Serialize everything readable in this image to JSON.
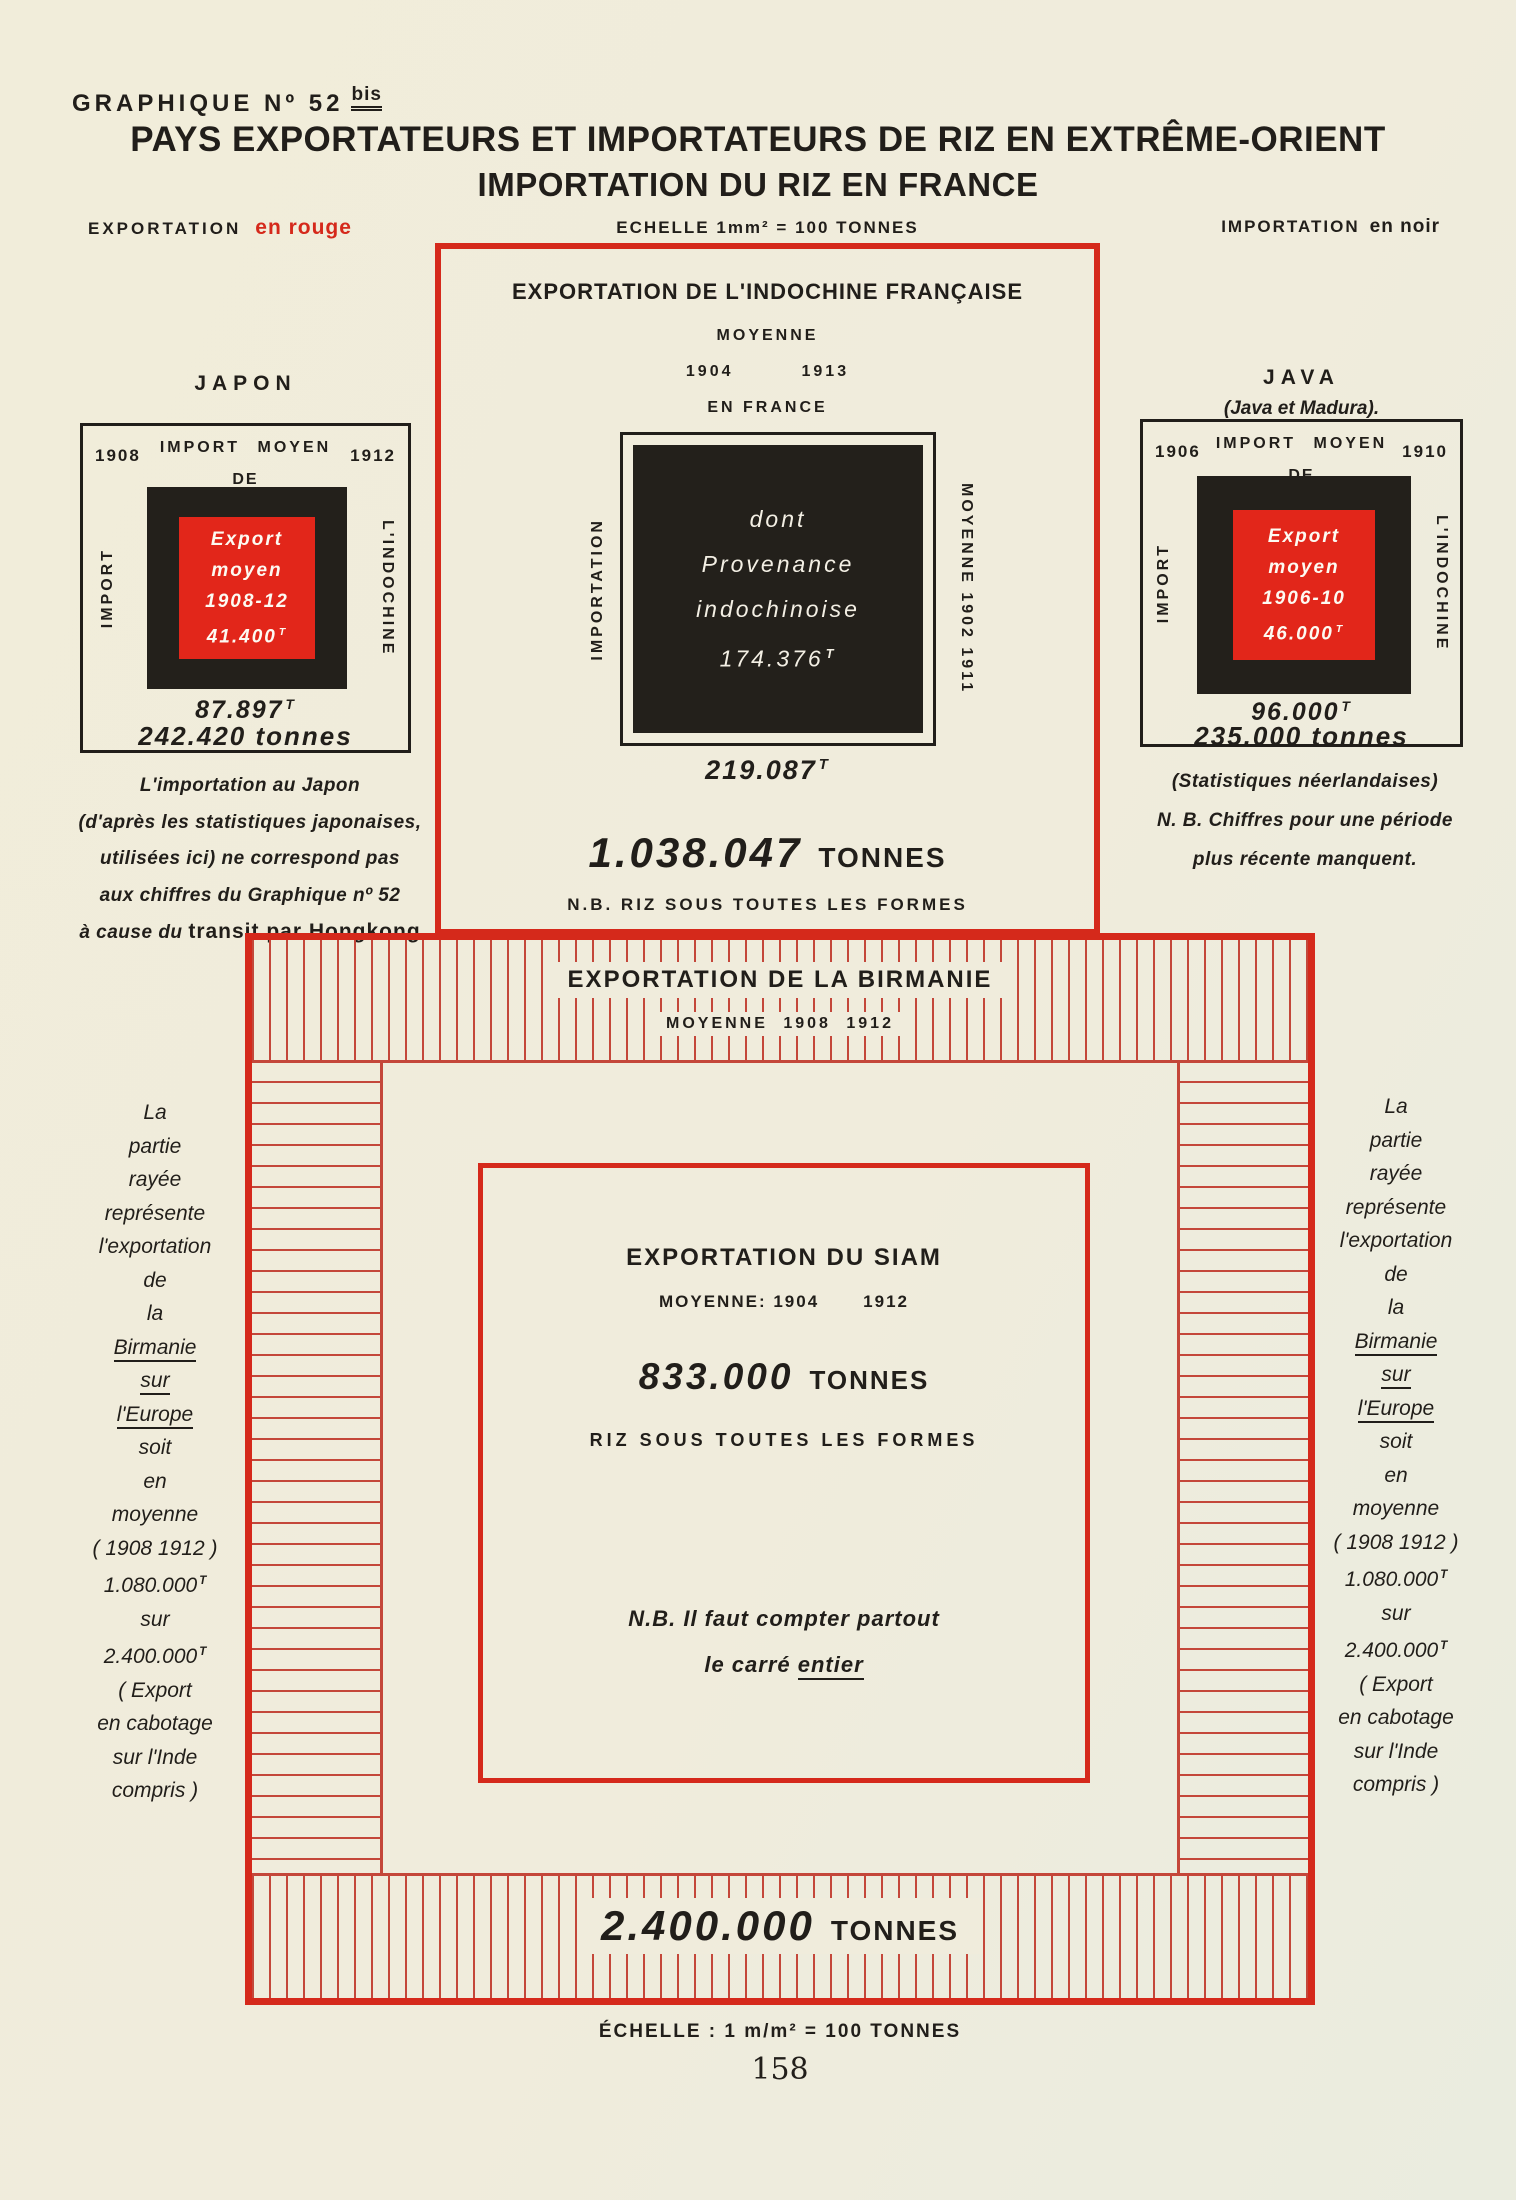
{
  "sup_t": "T",
  "colors": {
    "red": "#d5291b",
    "red_fill": "#e2261a",
    "hatch_red": "#c4473a",
    "ink": "#211e1a",
    "paper": "#f0ecdc"
  },
  "header": {
    "graph_label": "GRAPHIQUE Nº 52",
    "graph_label_sup": "bis",
    "title_line1": "PAYS EXPORTATEURS ET IMPORTATEURS DE RIZ EN EXTRÊME-ORIENT",
    "title_line2": "IMPORTATION DU RIZ EN FRANCE",
    "legend_export_label": "EXPORTATION",
    "legend_export_value": "en rouge",
    "scale_top": "ECHELLE 1mm² = 100 TONNES",
    "legend_import_label": "IMPORTATION",
    "legend_import_value": "en noir"
  },
  "japan": {
    "label": "JAPON",
    "year_start": "1908",
    "year_end": "1912",
    "band_top_line1": "IMPORT MOYEN",
    "band_top_line2": "DE",
    "band_left": "IMPORT",
    "band_right": "L'INDOCHINE",
    "center_lines": [
      "Export",
      "moyen",
      "1908-12",
      "41.400"
    ],
    "import_value": "87.897",
    "total_value": "242.420 tonnes",
    "note_lines": [
      "L'importation au Japon",
      "(d'après les statistiques japonaises,",
      "utilisées ici) ne correspond pas",
      "aux chiffres du Graphique nº 52",
      "à cause du "
    ],
    "note_bold": "transit par Hongkong"
  },
  "indochina": {
    "title": "EXPORTATION DE L'INDOCHINE FRANÇAISE",
    "moyenne": "MOYENNE",
    "year_start": "1904",
    "year_end": "1913",
    "en_france": "EN FRANCE",
    "band_left": "IMPORTATION",
    "band_right": "MOYENNE 1902 1911",
    "center_lines": [
      "dont",
      "Provenance",
      "indochinoise",
      "174.376"
    ],
    "france_value": "219.087",
    "total_number": "1.038.047",
    "total_unit": "TONNES",
    "note": "N.B. RIZ SOUS TOUTES LES FORMES"
  },
  "java": {
    "label": "JAVA",
    "sublabel": "(Java et Madura).",
    "year_start": "1906",
    "year_end": "1910",
    "band_top_line1": "IMPORT MOYEN",
    "band_top_line2": "DE",
    "band_left": "IMPORT",
    "band_right": "L'INDOCHINE",
    "center_lines": [
      "Export",
      "moyen",
      "1906-10",
      "46.000"
    ],
    "import_value": "96.000",
    "total_value": "235.000 tonnes",
    "note_lines": [
      "(Statistiques néerlandaises)",
      "N. B. Chiffres pour une période",
      "plus récente manquent."
    ]
  },
  "burma": {
    "title": "EXPORTATION DE LA BIRMANIE",
    "subtitle": "MOYENNE 1908 1912",
    "total_number": "2.400.000",
    "total_unit": "TONNES"
  },
  "siam": {
    "title": "EXPORTATION DU SIAM",
    "moyenne": "MOYENNE: 1904",
    "year2": "1912",
    "total_number": "833.000",
    "total_unit": "TONNES",
    "riz": "RIZ SOUS TOUTES LES FORMES",
    "nb1": "N.B. Il faut compter partout",
    "nb2_pre": "le carré ",
    "nb2_u": "entier"
  },
  "side_note": {
    "lines": [
      "La",
      "partie",
      "rayée",
      "représente",
      "l'exportation",
      "de",
      "la",
      "Birmanie",
      "sur",
      "l'Europe",
      "soit",
      "en",
      "moyenne",
      "( 1908  1912 )",
      "1.080.000",
      "sur",
      "2.400.000",
      "( Export",
      "en cabotage",
      "sur l'Inde",
      "compris )"
    ]
  },
  "footer": {
    "scale_bottom": "ÉCHELLE : 1 m/m² = 100 TONNES",
    "page_number": "158"
  },
  "chart_data": {
    "type": "area",
    "title": "Pays exportateurs et importateurs de riz en Extrême-Orient — Importation du riz en France",
    "scale": "1 mm² = 100 tonnes",
    "unit": "tonnes",
    "legend": {
      "exportation": "en rouge",
      "importation": "en noir"
    },
    "series": [
      {
        "name": "Japon",
        "measure": "Import moyen 1908-1912",
        "total": 242420,
        "dont_de_l_indochine": 87897,
        "export_moyen_1908_12": 41400
      },
      {
        "name": "Indochine française",
        "measure": "Exportation moyenne 1904-1913 (riz sous toutes les formes)",
        "total": 1038047,
        "importation_en_france_moyenne_1902_1911": 219087,
        "dont_provenance_indochinoise": 174376
      },
      {
        "name": "Java (Java et Madura)",
        "measure": "Import moyen 1906-1910",
        "total": 235000,
        "dont_de_l_indochine": 96000,
        "export_moyen_1906_10": 46000
      },
      {
        "name": "Birmanie",
        "measure": "Exportation moyenne 1908-1912 (export en cabotage sur l'Inde compris)",
        "total": 2400000,
        "dont_sur_l_europe": 1080000
      },
      {
        "name": "Siam",
        "measure": "Exportation moyenne 1904-1912 (riz sous toutes les formes)",
        "total": 833000
      }
    ]
  }
}
